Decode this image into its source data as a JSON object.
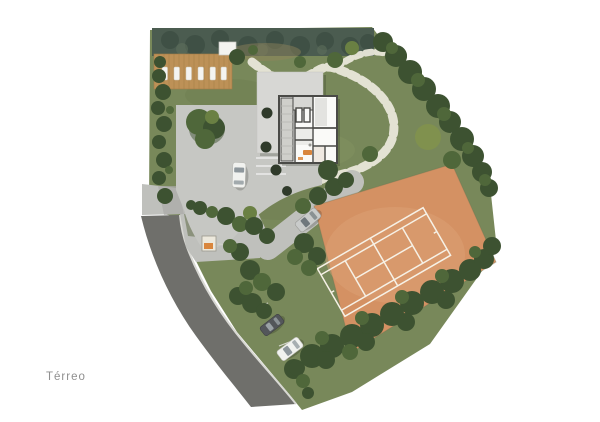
{
  "plan": {
    "label": "Térreo",
    "type": "site-plan"
  },
  "colors": {
    "background": "#ffffff",
    "label": "#8f8f8f",
    "lawn": "#78885a",
    "lawn_light": "#8b9a64",
    "lawn_dark": "#5d6e44",
    "tree_dark": "#3d5231",
    "tree_mid": "#4f673a",
    "tree_light": "#6a8043",
    "tree_pale": "#80914e",
    "hedge": "#4b5c50",
    "hedge_dark": "#39493f",
    "deck": "#bd9157",
    "deck_line": "#a37c47",
    "lounger": "#f4f4f1",
    "stone": "#e9e7da",
    "plaza": "#c6c7c3",
    "paving": "#bfc0bc",
    "paving_dark": "#a9aaa6",
    "slab": "#d7d7d4",
    "wall": "#4a4a47",
    "room": "#fafaf8",
    "room_gray": "#e3e3e0",
    "terrace": "#cfcfcb",
    "road": "#6f6f6b",
    "curb": "#d8d8d3",
    "clay": "#d49163",
    "clay_light": "#dda377",
    "court_line": "#f6f1e6",
    "car_white": "#f1f2ef",
    "car_silver": "#c9cbca",
    "car_dark": "#53565a",
    "glass": "#8e979c",
    "accent": "#d9863d",
    "shadow": "rgba(30,38,22,0.22)"
  }
}
